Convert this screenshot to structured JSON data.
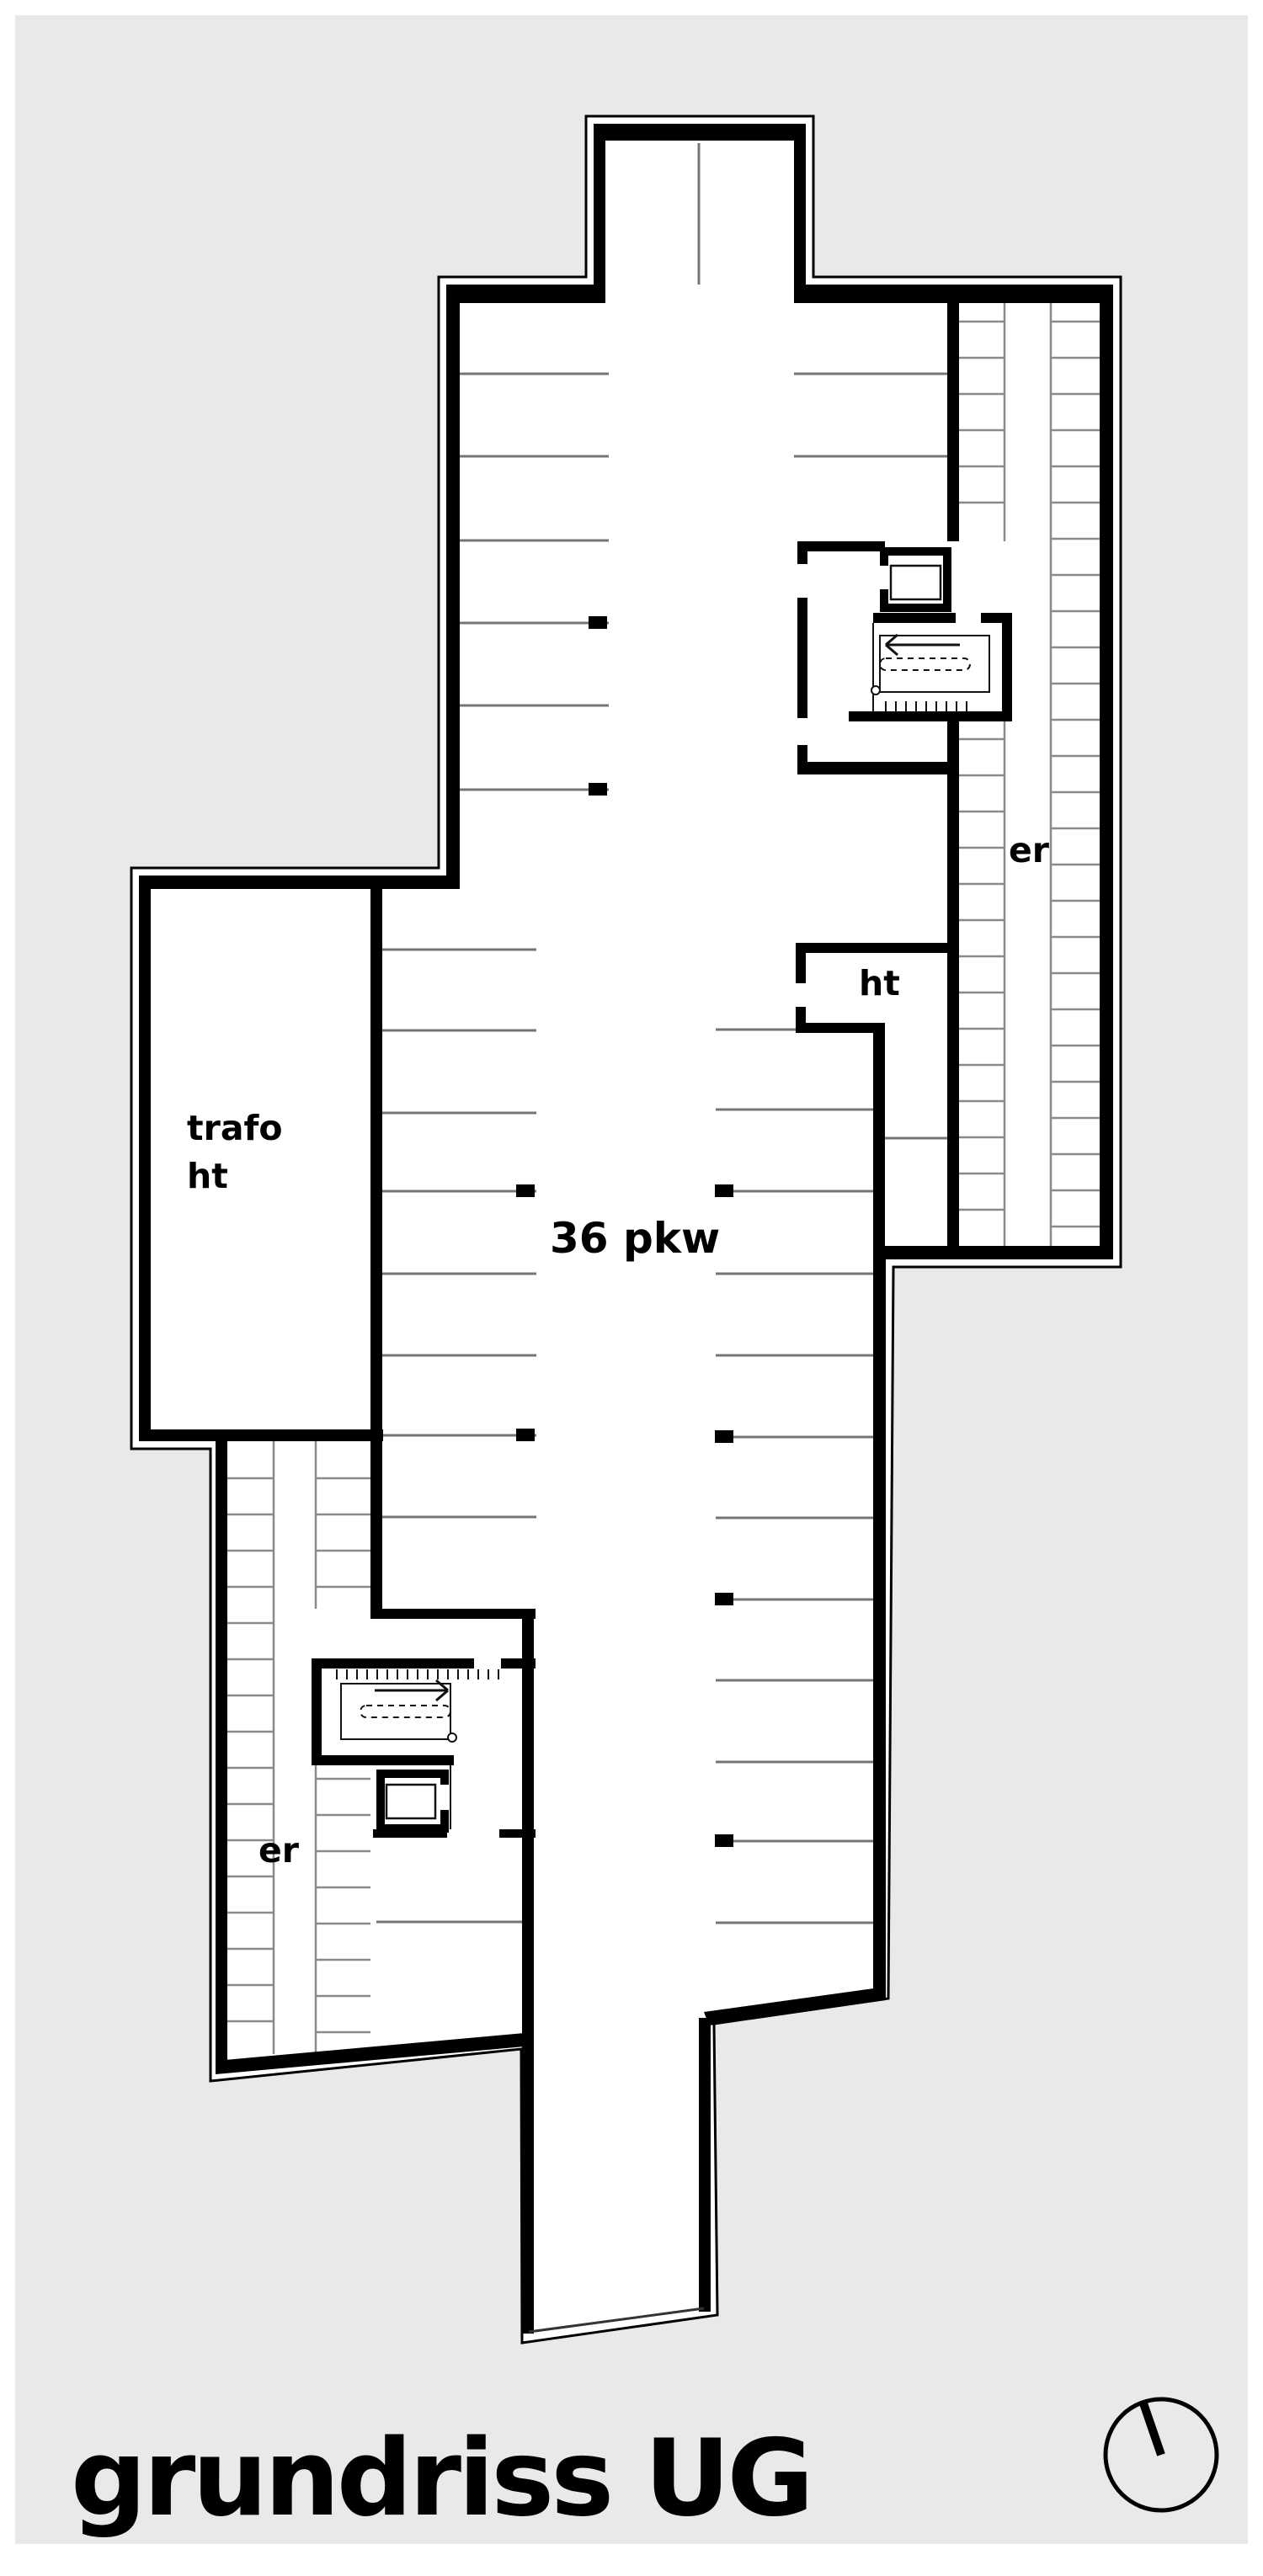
{
  "page": {
    "background_color": "#ffffff",
    "canvas_color": "#e9e9e9",
    "wall_color": "#000000",
    "stall_line_color": "#757575",
    "cell_line_color": "#8a8a8a"
  },
  "plan": {
    "room_labels": {
      "trafo_room_line1": "trafo",
      "trafo_room_line2": "ht",
      "ht_room": "ht",
      "storage_right": "er",
      "storage_left": "er",
      "parking_count": "36 pkw"
    }
  },
  "footer": {
    "title": "grundriss UG"
  },
  "icons": {
    "north_arrow": "north-arrow-icon"
  }
}
